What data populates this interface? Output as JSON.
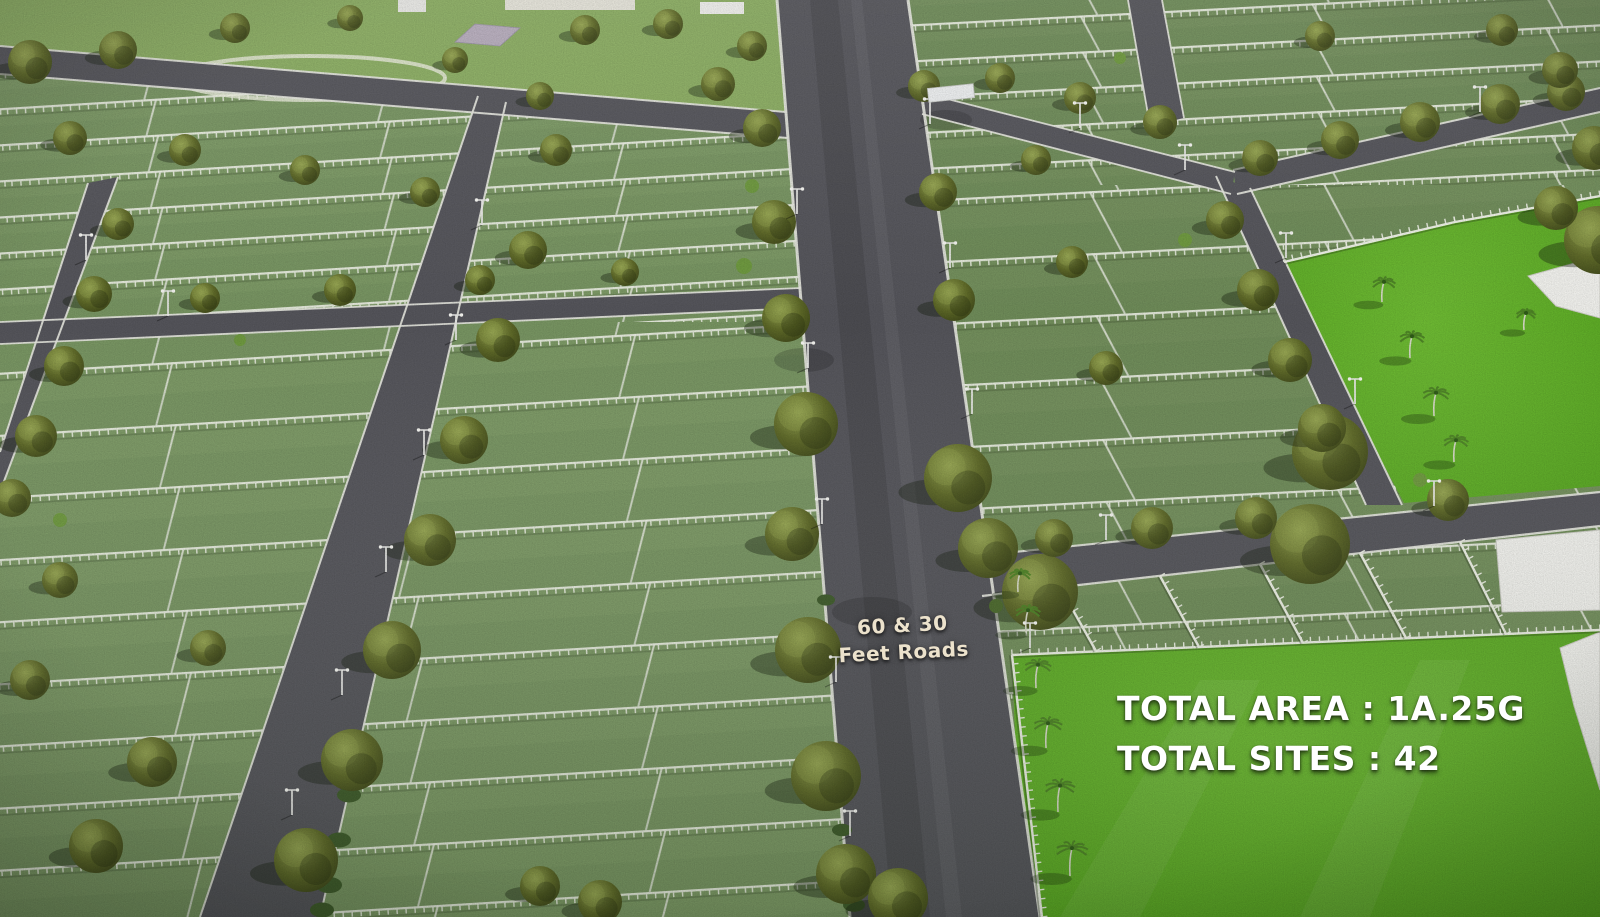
{
  "overlays": {
    "road_label": {
      "line1": "60 & 30",
      "line2": "Feet Roads"
    },
    "stats": {
      "total_area_label": "TOTAL AREA",
      "total_area_value": "1A.25G",
      "total_area_text": "TOTAL AREA : 1A.25G",
      "total_sites_label": "TOTAL SITES",
      "total_sites_value": "42",
      "total_sites_text": "TOTAL SITES : 42"
    }
  },
  "palette": {
    "road_asphalt": "#56565c",
    "curb_white": "#e8e9e1",
    "plot_grass": "#7d9a66",
    "plot_grass_right": "#74905d",
    "lawn_bright": "#5fae24",
    "fence_white": "#eff2e7",
    "tree_olive": "#5f6a28",
    "palm_green": "#4e8426",
    "wall_white": "#f3f3ef",
    "road_label_color": "#ece2cc",
    "stats_color": "#ffffff"
  }
}
